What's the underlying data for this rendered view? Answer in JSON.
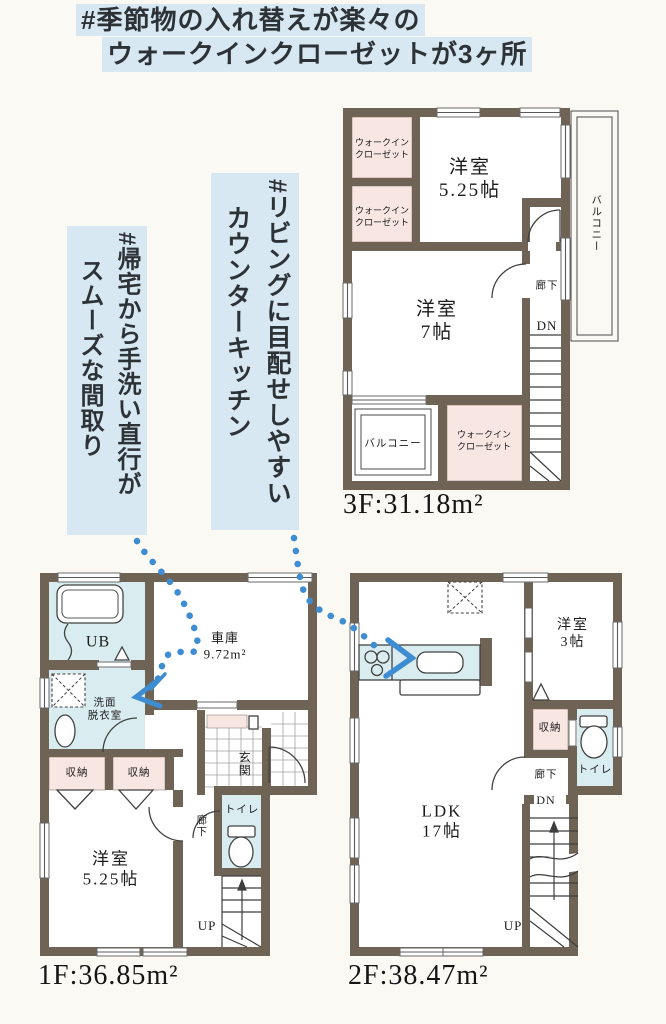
{
  "header": {
    "line1": "#季節物の入れ替えが楽々の",
    "line2": "ウォークインクローゼットが3ヶ所"
  },
  "callouts": {
    "living": {
      "line1": "#リビングに目配せしやすい",
      "line2": "カウンターキッチン"
    },
    "wash": {
      "line1": "#帰宅から手洗い直行が",
      "line2": "スムーズな間取り"
    }
  },
  "colors": {
    "highlight": "#d7e8f2",
    "wall": "#6f6355",
    "closet_pink": "#f8e6e3",
    "wet_blue": "#d9edf1",
    "trail_blue": "#3e8cd1"
  },
  "floor3": {
    "area": "3F:31.18m²",
    "wic_top": {
      "line1": "ウォークイン",
      "line2": "クローゼット"
    },
    "wic_mid": {
      "line1": "ウォークイン",
      "line2": "クローゼット"
    },
    "wic_bottom": {
      "line1": "ウォークイン",
      "line2": "クローゼット"
    },
    "room_525": {
      "line1": "洋室",
      "line2": "5.25帖"
    },
    "room_7": {
      "line1": "洋室",
      "line2": "7帖"
    },
    "hallway": "廊下",
    "dn": "DN",
    "balcony_right": "バルコニー",
    "balcony_bottom": "バルコニー"
  },
  "floor1": {
    "area": "1F:36.85m²",
    "ub": "UB",
    "washroom": {
      "line1": "洗面",
      "line2": "脱衣室"
    },
    "garage": {
      "line1": "車庫",
      "line2": "9.72m²"
    },
    "storage1": "収納",
    "storage2": "収納",
    "room_525": {
      "line1": "洋室",
      "line2": "5.25帖"
    },
    "entrance": "玄関",
    "hallway": "廊下",
    "toilet": "トイレ",
    "up": "UP"
  },
  "floor2": {
    "area": "2F:38.47m²",
    "ldk": {
      "line1": "LDK",
      "line2": "17帖"
    },
    "room_3": {
      "line1": "洋室",
      "line2": "3帖"
    },
    "storage": "収納",
    "toilet": "トイレ",
    "hallway": "廊下",
    "dn": "DN",
    "up": "UP"
  }
}
